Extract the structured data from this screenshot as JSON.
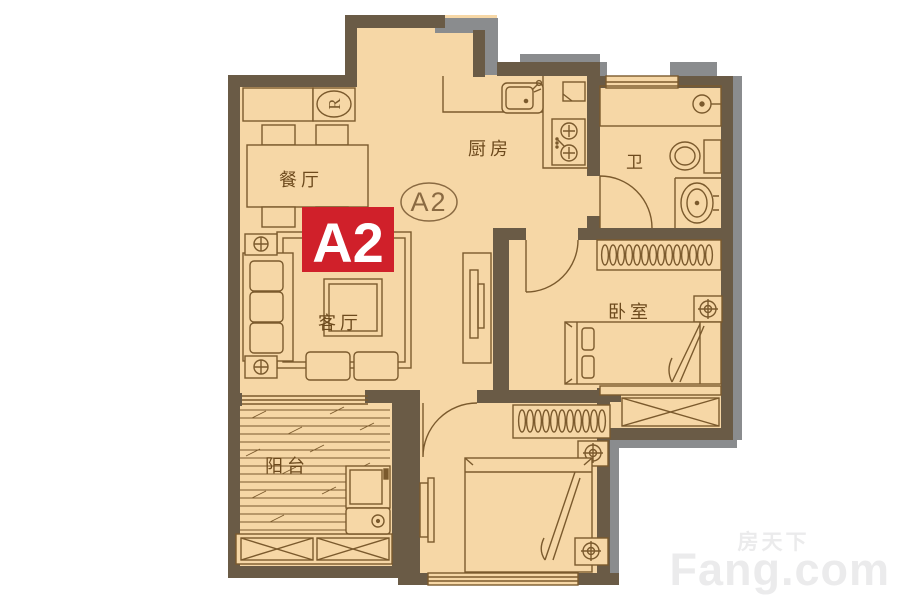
{
  "plan": {
    "unit_badge": "A2",
    "unit_circle_label": "A2",
    "rooms": {
      "dining": "餐厅",
      "kitchen": "厨房",
      "bathroom": "卫",
      "bedroom": "卧室",
      "living": "客厅",
      "balcony": "阳台"
    },
    "fridge_label": "R"
  },
  "watermark": {
    "cn": "房天下",
    "en": "Fang.com"
  },
  "colors": {
    "floor": "#f6d7a6",
    "wall": "#6a5b46",
    "wall_shadow": "#8a8c8e",
    "furniture_outline": "#7b5a2d",
    "badge_red": "#d0202a",
    "badge_text": "#ffffff",
    "label_text": "#6d4a1d"
  }
}
